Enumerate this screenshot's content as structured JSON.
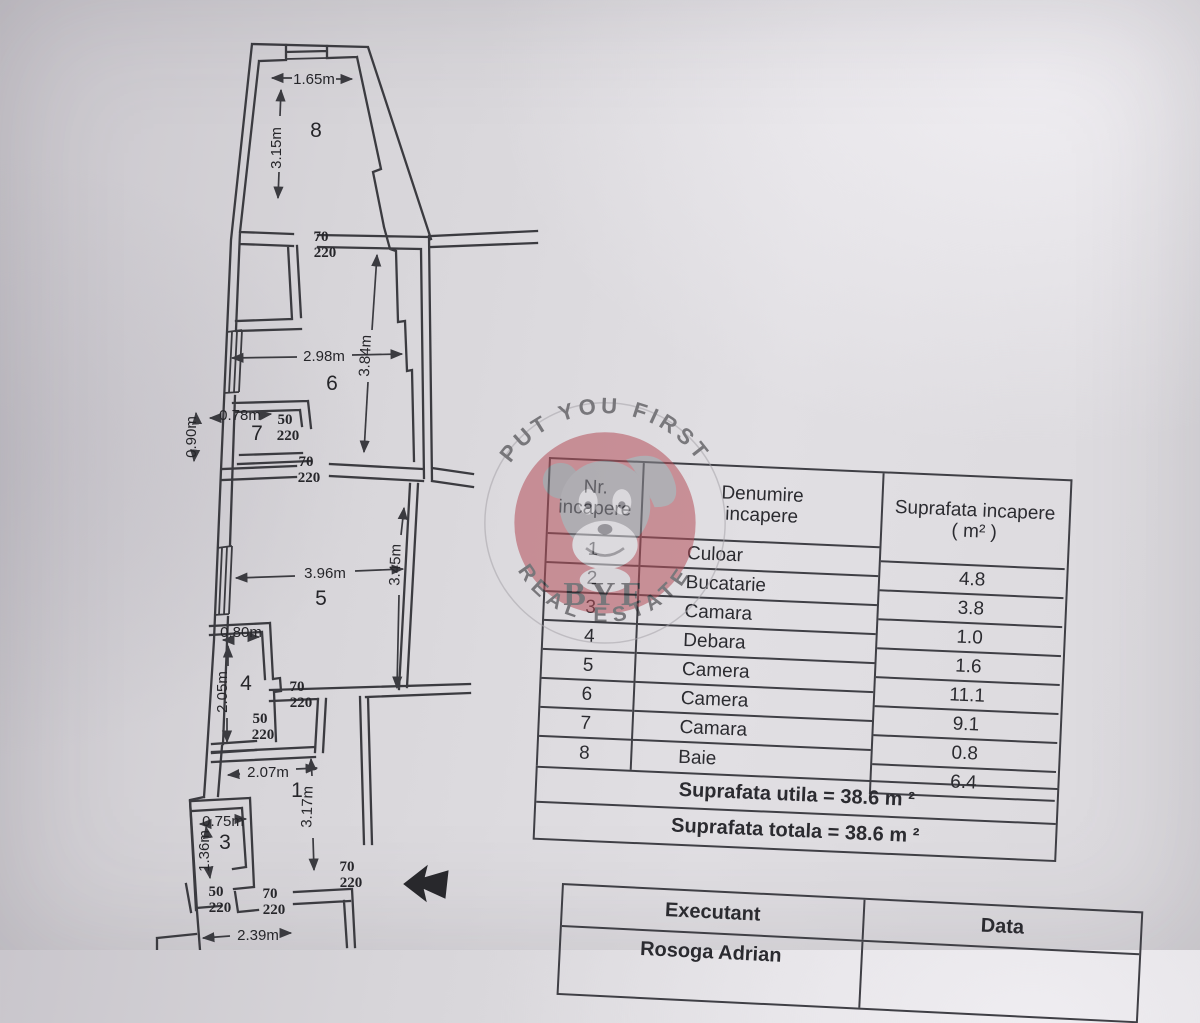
{
  "watermark": {
    "arc_top": "PUT YOU FIRST",
    "arc_bottom": "REAL ESTATE",
    "monogram": "BYF"
  },
  "rooms_table": {
    "header": {
      "col1": [
        "Nr.",
        "incapere"
      ],
      "col2": [
        "Denumire",
        "incapere"
      ],
      "col3": [
        "Suprafata incapere",
        "( m² )"
      ]
    },
    "rows": [
      {
        "nr": "1",
        "name": "Culoar",
        "area": "4.8"
      },
      {
        "nr": "2",
        "name": "Bucatarie",
        "area": "3.8"
      },
      {
        "nr": "3",
        "name": "Camara",
        "area": "1.0"
      },
      {
        "nr": "4",
        "name": "Debara",
        "area": "1.6"
      },
      {
        "nr": "5",
        "name": "Camera",
        "area": "11.1"
      },
      {
        "nr": "6",
        "name": "Camera",
        "area": "9.1"
      },
      {
        "nr": "7",
        "name": "Camara",
        "area": "0.8"
      },
      {
        "nr": "8",
        "name": "Baie",
        "area": "6.4"
      }
    ],
    "footer_utila": "Suprafata utila = 38.6 m ²",
    "footer_totala": "Suprafata totala = 38.6 m ²"
  },
  "signature_table": {
    "executant_label": "Executant",
    "data_label": "Data",
    "executant_name": "Rosoga Adrian"
  },
  "plan": {
    "rooms": [
      "8",
      "6",
      "7",
      "5",
      "4",
      "1",
      "3"
    ],
    "dims": [
      "1.65m",
      "3.15m",
      "2.98m",
      "3.84m",
      "0.78m",
      "0.90m",
      "3.96m",
      "3.45m",
      "0.80m",
      "2.05m",
      "2.07m",
      "3.17m",
      "0.75m",
      "1.36m",
      "2.39m"
    ],
    "doors": [
      {
        "w": "70",
        "h": "220"
      },
      {
        "w": "50",
        "h": "220"
      },
      {
        "w": "70",
        "h": "220"
      },
      {
        "w": "70",
        "h": "220"
      },
      {
        "w": "50",
        "h": "220"
      },
      {
        "w": "50",
        "h": "220"
      },
      {
        "w": "70",
        "h": "220"
      },
      {
        "w": "70",
        "h": "220"
      }
    ]
  }
}
